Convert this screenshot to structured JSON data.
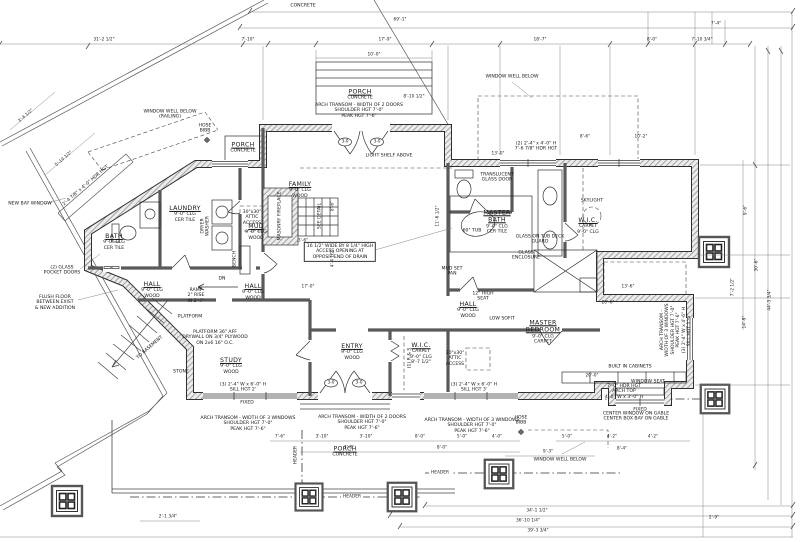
{
  "rooms": {
    "family": {
      "n": "FAMILY",
      "s": [
        "9'-0\" CLG",
        "WOOD"
      ]
    },
    "master_bath": {
      "n": [
        "MASTER",
        "BATH"
      ],
      "s": [
        "9'-0\" CLG",
        "CER TILE"
      ]
    },
    "master_bedroom": {
      "n": [
        "MASTER",
        "BEDROOM"
      ],
      "s": [
        "9'-0\" CLG",
        "CARPET"
      ]
    },
    "wic_master": {
      "n": "W.I.C.",
      "s": [
        "CARPET",
        "9'-0\" CLG"
      ]
    },
    "wic_entry": {
      "n": "W.I.C.",
      "s": [
        "CARPET",
        "9'-0\" CLG",
        "8'-7 1/2\""
      ]
    },
    "entry": {
      "n": "ENTRY",
      "s": [
        "9'-0\" CLG",
        "WOOD"
      ]
    },
    "study": {
      "n": "STUDY",
      "s": [
        "9'-0\" CLG",
        "WOOD"
      ]
    },
    "hall": {
      "n": "HALL",
      "s": [
        "9'-0\" CLG",
        "WOOD"
      ]
    },
    "bath": {
      "n": "BATH",
      "s": [
        "9'-0\" CLG",
        "CER TILE"
      ]
    },
    "laundry": {
      "n": "LAUNDRY",
      "s": [
        "9'-0\" CLG",
        "CER TILE"
      ]
    },
    "mud": {
      "n": "MUD",
      "s": [
        "9'-0\" CLG",
        "WOOD"
      ]
    },
    "porch": {
      "n": "PORCH",
      "s": "CONCRETE"
    }
  },
  "ann": {
    "concrete": "CONCRETE",
    "window_well": "WINDOW WELL BELOW",
    "window_well_railing": [
      "WINDOW WELL BELOW",
      "(RAILING)"
    ],
    "light_shelf": "LIGHT SHELF ABOVE",
    "arch_2_doors": [
      "ARCH TRANSOM - WIDTH OF 2 DOORS",
      "SHOULDER HGT 7'-0\"",
      "PEAK HGT 7'-6\""
    ],
    "arch_3_windows": [
      "ARCH TRANSOM - WIDTH OF 3 WINDOWS",
      "SHOULDER HGT 7'-0\"",
      "PEAK HGT 7'-6\""
    ],
    "side_note": [
      "ARCH TRANSOM -",
      "WIDTH OF 3 WINDOWS",
      "SHOULDER HGT 7'-0\"",
      "PEAK HGT 7'-6\"",
      "(3) 2'-4\" W x 4'-6\" H",
      "SILL HGT 1'-6\""
    ],
    "center_gable": [
      "CENTER WINDOW ON GABLE",
      "CENTER BOX BAY ON GABLE"
    ],
    "built_in": "BUILT IN CABINETS",
    "window_seat": "WINDOW SEAT",
    "arch_top_note": [
      "7'-0\" HDR HGT",
      "ARCH TOP",
      "4'-0\" W x 3'-0\" H"
    ],
    "hose_bibb": [
      "HOSE",
      "BIBB"
    ],
    "skylight": "SKYLIGHT",
    "fireplace": "MASONRY FIREPLACE",
    "see_detail": "SEE DETAIL",
    "flush_floor": [
      "FLUSH FLOOR",
      "BETWEEN EXIST",
      "& NEW ADDITION"
    ],
    "pocket_doors": [
      "(2) GLASS",
      "POCKET DOORS"
    ],
    "bay_window": "NEW BAY WINDOW",
    "to_basement": "TO BASEMENT",
    "platform": "PLATFORM",
    "platform_note": [
      "PLATFORM 36\" AFF",
      "DRYWALL ON 3/4\" PLYWOOD",
      "ON 2x6 16\" O.C."
    ],
    "ramp": [
      "RAMP",
      "2\" RISE",
      "IN 2'-7\""
    ],
    "access_note": [
      "16 1/2\" WIDE BY 8 1/4\" HIGH",
      "ACCESS OPENING AT",
      "OPPOSIT END OF DRAIN"
    ],
    "tub": "60\" TUB",
    "glass_deck": [
      "GLASS ON TUB DECK",
      "GUARD"
    ],
    "glass_encl": [
      "GLASS",
      "ENCLOSURE"
    ],
    "mud_pan": [
      "MUD SET",
      "PAN"
    ],
    "seat": [
      "12\" HIGH",
      "SEAT"
    ],
    "soffit": "LOW SOFIT",
    "trans_door": [
      "TRANSLUCENT",
      "GLASS DOOR"
    ],
    "dryer_washer": [
      "DRYER",
      "WASHER"
    ],
    "bench": "BENCH",
    "attic": [
      "30\"x30\"",
      "ATTIC",
      "ACCESS"
    ],
    "header": "HEADER",
    "stone": "STONE",
    "fixed": "FIXED",
    "dn": "DN",
    "rs": "(1) R & S",
    "study_win": [
      "(3) 2'-4\" W x 6'-0\" H",
      "SILL HGT 2'"
    ],
    "south_win": [
      "(3) 2'-4\" W x 6'-0\" H",
      "SILL HGT 3'"
    ],
    "top_win": [
      "(2) 2'-4\" x 4'-0\" H",
      "7'-6 7/8\" HDR HGT"
    ],
    "diag_win": "2'-4 7/8\" x 4'-0\" HDR HGT",
    "door30": "3-0"
  },
  "dims": {
    "d69": "69'-1\"",
    "d31": "31'-2 1/2\"",
    "d710": "7'-10\"",
    "d179": "17'-9\"",
    "d10": "10'-0\"",
    "d187": "18'-7\"",
    "d80": "8'-0\"",
    "d7103": "7'-10 3/4\"",
    "d74": "7'-4\"",
    "d810": "8'-10 1/2\"",
    "d86": "8'-6\"",
    "d102": "10'-2\"",
    "d130": "13'-0\"",
    "d96": "9'-6\"",
    "d306": "30'-6\"",
    "d445": "44'-5 3/4\"",
    "d72": "7'-2 1/2\"",
    "d149": "14'-9\"",
    "d136": "13'-6\"",
    "d206": "20'-6\"",
    "d200": "20'-0\"",
    "d341": "34'-1 1/2\"",
    "d3610": "36'-10 1/4\"",
    "d393": "39'-3 3/4\"",
    "d21": "2'-1 3/4\"",
    "d29": "2'-9\"",
    "d93": "9'-3\"",
    "d84": "8'-4\"",
    "d50": "5'-0\"",
    "d42": "4'-2\"",
    "d76": "7'-6\"",
    "d310": "3'-10\"",
    "d78": "7'-8\"",
    "d170": "17'-0\"",
    "d1161": "11'-6 1/2\"",
    "d441": "4'-4 1/2\"",
    "d36": "3'-6\"",
    "d344": "3'-4 1/2\"",
    "d5101": "5'-10 1/2\"",
    "d40": "4'-0\""
  }
}
